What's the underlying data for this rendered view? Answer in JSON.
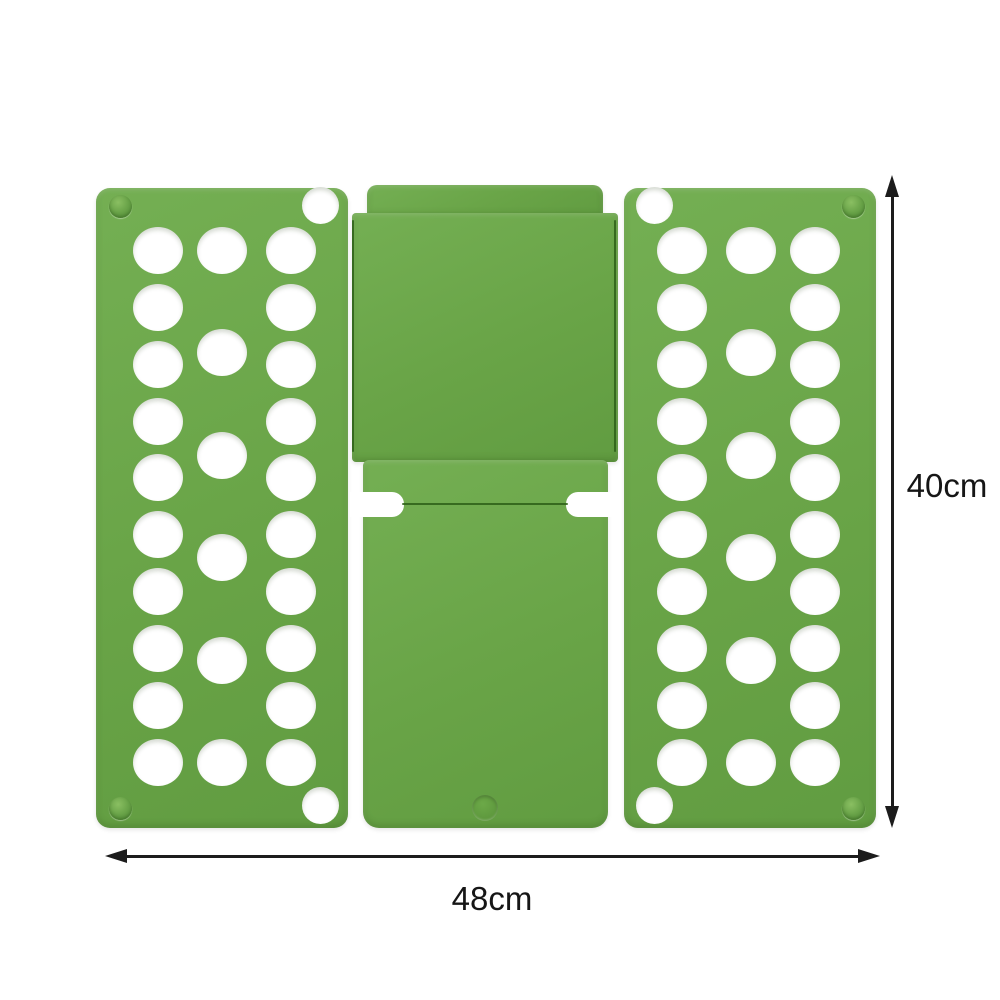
{
  "scene": {
    "background": "#ffffff",
    "width": 1000,
    "height": 1000
  },
  "board": {
    "plastic_color": "#69a447",
    "seam_color": "#2d5f17",
    "hole_color": "#ffffff",
    "panels": {
      "left_panel": {
        "x": 96,
        "y": 188,
        "w": 252,
        "h": 640,
        "radius": "14px",
        "outer_col_xs": [
          158,
          291
        ],
        "outer_row_ys": [
          250,
          307,
          364,
          421,
          477,
          534,
          591,
          648,
          705,
          762
        ],
        "mid_col_x": 222,
        "mid_row_ys": [
          250,
          352,
          455,
          557,
          660,
          762
        ],
        "hole_d": 50,
        "corner_holes": [
          {
            "x": 320,
            "y": 205,
            "d": 37
          },
          {
            "x": 320,
            "y": 805,
            "d": 37
          }
        ],
        "rivets": [
          {
            "x": 120,
            "y": 206,
            "d": 23
          },
          {
            "x": 120,
            "y": 808,
            "d": 23
          }
        ]
      },
      "right_panel": {
        "x": 624,
        "y": 188,
        "w": 252,
        "h": 640,
        "radius": "14px",
        "outer_col_xs": [
          682,
          815
        ],
        "outer_row_ys": [
          250,
          307,
          364,
          421,
          477,
          534,
          591,
          648,
          705,
          762
        ],
        "mid_col_x": 751,
        "mid_row_ys": [
          250,
          352,
          455,
          557,
          660,
          762
        ],
        "hole_d": 50,
        "corner_holes": [
          {
            "x": 654,
            "y": 205,
            "d": 37
          },
          {
            "x": 654,
            "y": 805,
            "d": 37
          }
        ],
        "rivets": [
          {
            "x": 853,
            "y": 206,
            "d": 23
          },
          {
            "x": 853,
            "y": 808,
            "d": 23
          }
        ]
      },
      "top_center": {
        "cap": {
          "x": 367,
          "y": 185,
          "w": 236,
          "h": 32,
          "radius": "10px 10px 0 0"
        },
        "main": {
          "x": 352,
          "y": 213,
          "w": 266,
          "h": 249,
          "radius": "4px"
        },
        "seam_left": {
          "x": 352,
          "y": 220,
          "w": 2,
          "h": 232
        },
        "seam_right": {
          "x": 614,
          "y": 220,
          "w": 2,
          "h": 232
        }
      },
      "bottom_center": {
        "body": {
          "x": 363,
          "y": 460,
          "w": 245,
          "h": 368,
          "radius": "6px 6px 16px 16px"
        },
        "notch_left": {
          "x": 350,
          "y": 492,
          "w": 54,
          "h": 25,
          "radius": "0 12px 12px 0"
        },
        "notch_right": {
          "x": 566,
          "y": 492,
          "w": 54,
          "h": 25,
          "radius": "12px 0 0 12px"
        },
        "seam_mid": {
          "x": 402,
          "y": 503,
          "w": 166,
          "h": 2
        },
        "dimple": {
          "x": 485,
          "y": 808,
          "d": 26
        }
      }
    }
  },
  "dimensions": {
    "ink_color": "#1c1c1c",
    "height": {
      "label": "40cm",
      "line_rect": {
        "x": 891,
        "y": 195,
        "w": 3,
        "h": 612
      },
      "head_top": {
        "x": 885,
        "y": 175
      },
      "head_bottom": {
        "x": 885,
        "y": 806
      },
      "label_rect": {
        "x": 893,
        "y": 465,
        "w": 108,
        "h": 42
      }
    },
    "width": {
      "label": "48cm",
      "line_rect": {
        "x": 123,
        "y": 855,
        "w": 736,
        "h": 3
      },
      "head_left": {
        "x": 105,
        "y": 849
      },
      "head_right": {
        "x": 858,
        "y": 849
      },
      "label_rect": {
        "x": 417,
        "y": 878,
        "w": 150,
        "h": 42
      }
    }
  }
}
